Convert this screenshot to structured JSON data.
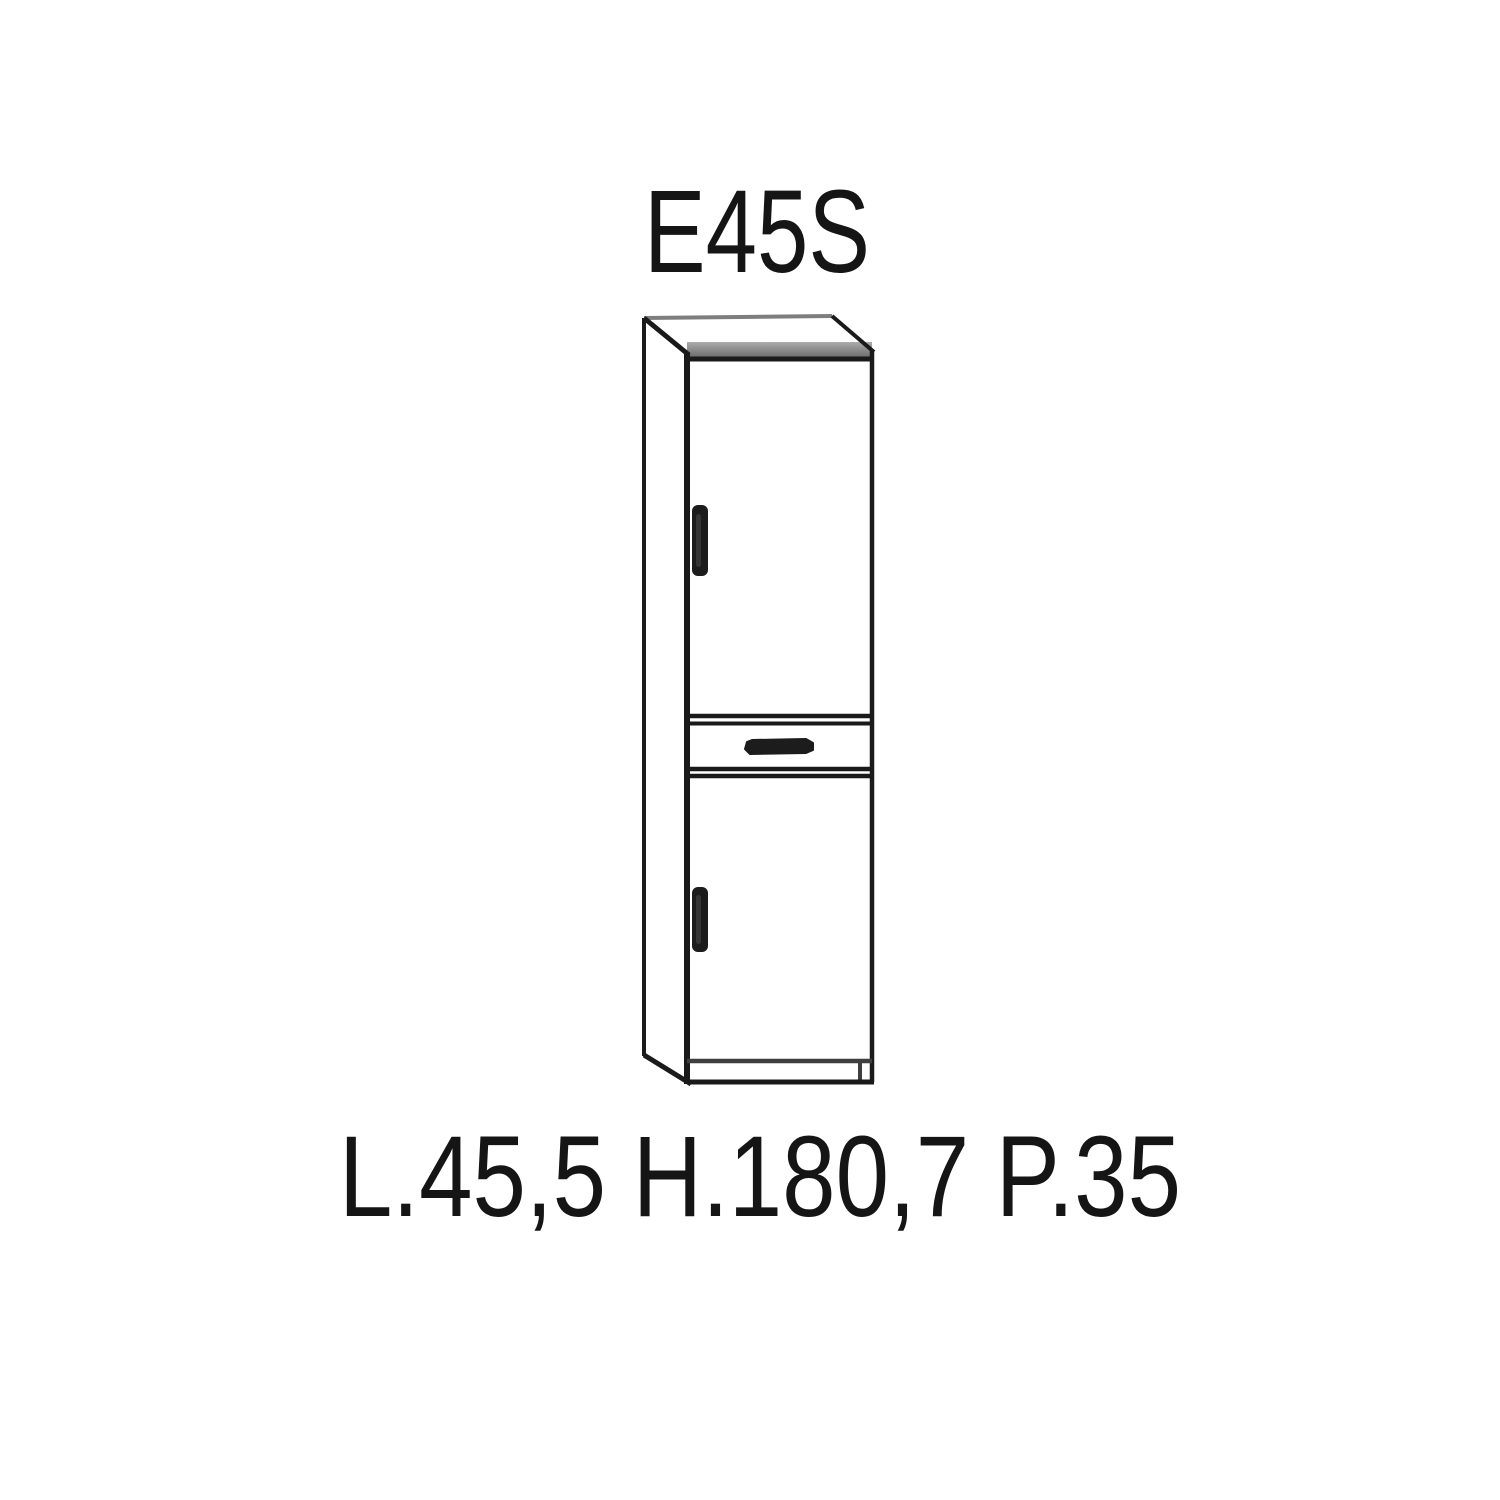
{
  "product": {
    "code": "E45S",
    "dimensions_label": "L.45,5 H.180,7 P.35",
    "dimensions": {
      "L": "45,5",
      "H": "180,7",
      "P": "35"
    }
  },
  "drawing": {
    "type": "furniture-technical-drawing",
    "subject": "tall column cabinet with top door, center drawer and bottom door",
    "parts": [
      "top-panel",
      "left-side-panel",
      "top-door",
      "drawer",
      "bottom-door",
      "plinth"
    ],
    "handles": [
      "top-door-handle",
      "drawer-handle",
      "bottom-door-handle"
    ]
  },
  "colors": {
    "background": "#ffffff",
    "line": "#1a1a1a",
    "soft_line": "#3f3f3f",
    "back_edge_gray": "#7e7e7e",
    "top_band_gray": "#8f8f8f",
    "handle": "#1c1c1c",
    "text": "#151515"
  }
}
